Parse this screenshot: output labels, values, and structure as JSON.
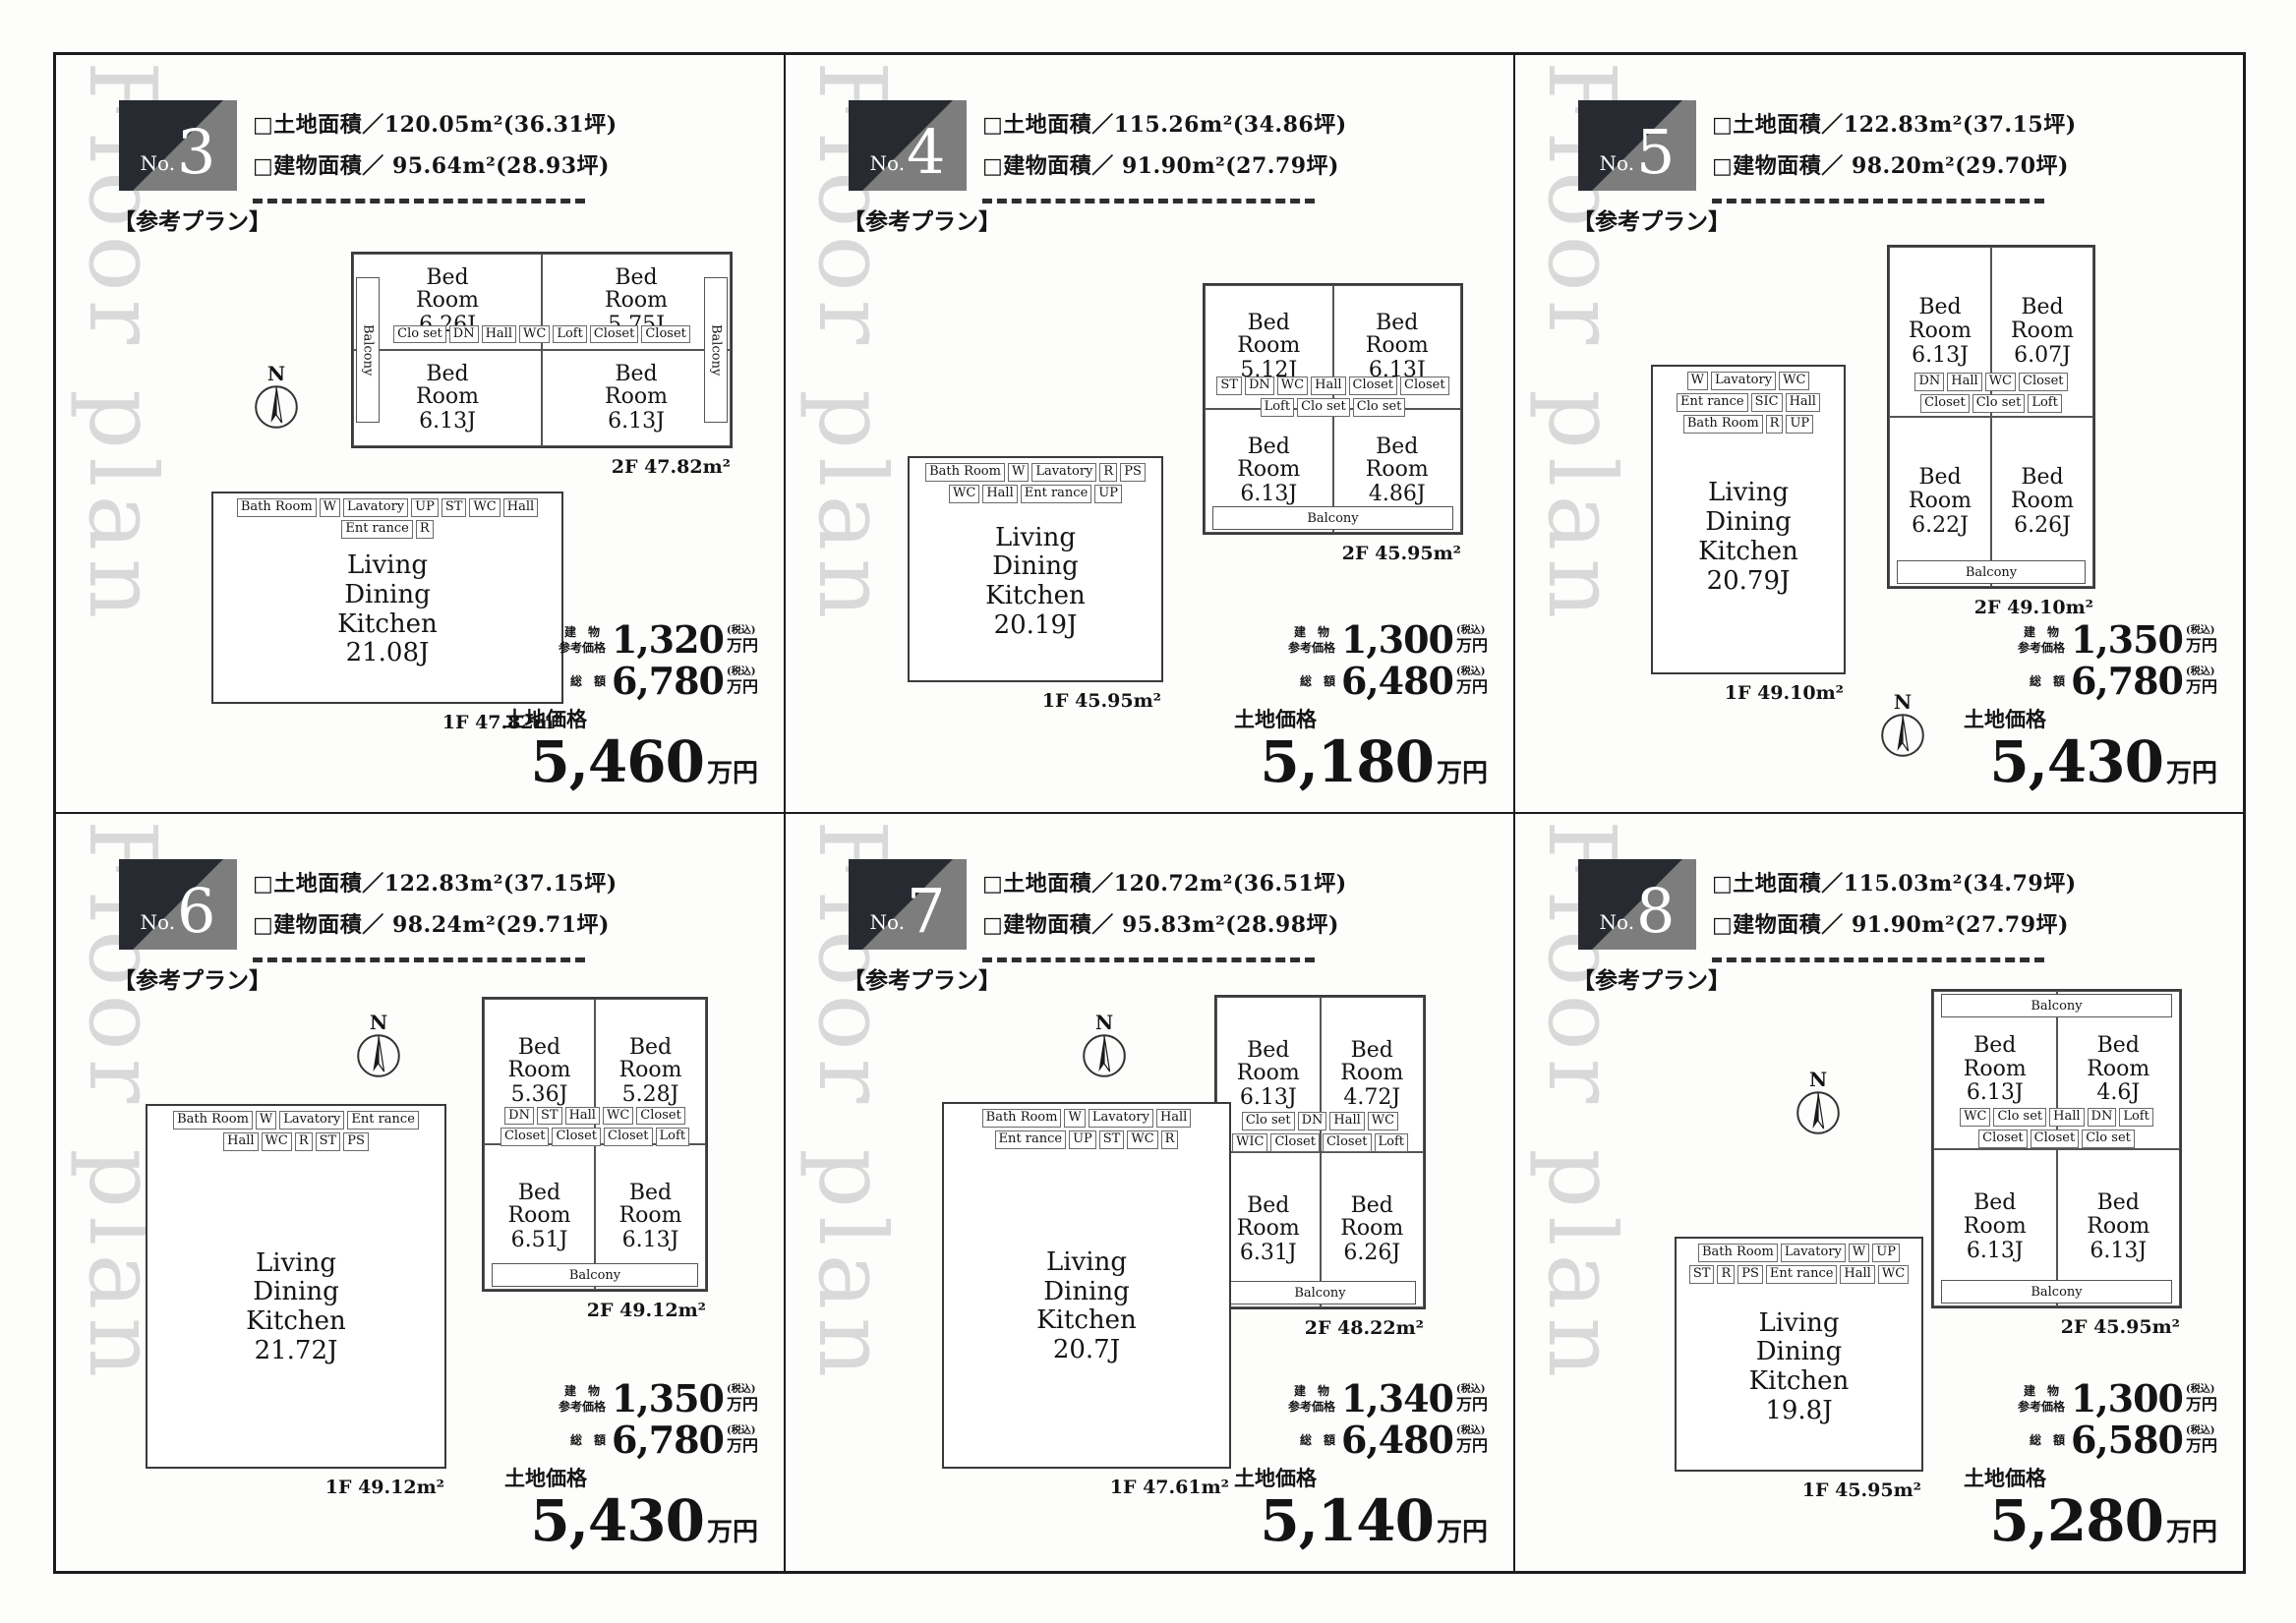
{
  "watermark": "Floor plan",
  "compass_n": "N",
  "panels": [
    {
      "badge": {
        "prefix": "No.",
        "number": "3"
      },
      "land_area": "□土地面積／120.05m²(36.31坪)",
      "building_area": "□建物面積／ 95.64m²(28.93坪)",
      "plan_note": "【参考プラン】",
      "compass": true,
      "floors": [
        {
          "id": "2F",
          "layout": "2x2",
          "area_label": "2F 47.82m²",
          "rooms": [
            {
              "name": "Bed Room",
              "size": "6.26J"
            },
            {
              "name": "Bed Room",
              "size": "5.75J"
            },
            {
              "name": "Bed Room",
              "size": "6.13J"
            },
            {
              "name": "Bed Room",
              "size": "6.13J"
            }
          ],
          "chips": [
            "Clo set",
            "DN",
            "Hall",
            "WC",
            "Loft",
            "Closet",
            "Closet"
          ],
          "balconies": [
            {
              "pos": "left",
              "label": "Balcony"
            },
            {
              "pos": "right",
              "label": "Balcony"
            }
          ]
        },
        {
          "id": "1F",
          "layout": "open",
          "area_label": "1F 47.82m²",
          "rooms": [
            {
              "name": "Living Dining Kitchen",
              "size": "21.08J"
            }
          ],
          "chips": [
            "Bath Room",
            "W",
            "Lavatory",
            "UP",
            "ST",
            "WC",
            "Hall",
            "Ent rance",
            "R"
          ],
          "balconies": []
        }
      ],
      "prices": {
        "building_label": "建　物\n参考価格",
        "building_value": "1,320",
        "tax_note": "(税込)",
        "unit": "万円",
        "total_label": "総　額",
        "total_value": "6,780",
        "land_label": "土地価格",
        "land_value": "5,460",
        "land_unit": "万円"
      }
    },
    {
      "badge": {
        "prefix": "No.",
        "number": "4"
      },
      "land_area": "□土地面積／115.26m²(34.86坪)",
      "building_area": "□建物面積／ 91.90m²(27.79坪)",
      "plan_note": "【参考プラン】",
      "compass": false,
      "floors": [
        {
          "id": "2F",
          "layout": "2x2",
          "area_label": "2F 45.95m²",
          "rooms": [
            {
              "name": "Bed Room",
              "size": "5.12J"
            },
            {
              "name": "Bed Room",
              "size": "6.13J"
            },
            {
              "name": "Bed Room",
              "size": "6.13J"
            },
            {
              "name": "Bed Room",
              "size": "4.86J"
            }
          ],
          "chips": [
            "ST",
            "DN",
            "WC",
            "Hall",
            "Closet",
            "Closet",
            "Loft",
            "Clo set",
            "Clo set"
          ],
          "balconies": [
            {
              "pos": "bottom",
              "label": "Balcony"
            }
          ]
        },
        {
          "id": "1F",
          "layout": "open",
          "area_label": "1F 45.95m²",
          "rooms": [
            {
              "name": "Living Dining Kitchen",
              "size": "20.19J"
            }
          ],
          "chips": [
            "Bath Room",
            "W",
            "Lavatory",
            "R",
            "PS",
            "WC",
            "Hall",
            "Ent rance",
            "UP"
          ],
          "balconies": []
        }
      ],
      "prices": {
        "building_label": "建　物\n参考価格",
        "building_value": "1,300",
        "tax_note": "(税込)",
        "unit": "万円",
        "total_label": "総　額",
        "total_value": "6,480",
        "land_label": "土地価格",
        "land_value": "5,180",
        "land_unit": "万円"
      }
    },
    {
      "badge": {
        "prefix": "No.",
        "number": "5"
      },
      "land_area": "□土地面積／122.83m²(37.15坪)",
      "building_area": "□建物面積／ 98.20m²(29.70坪)",
      "plan_note": "【参考プラン】",
      "compass": true,
      "floors": [
        {
          "id": "2F",
          "layout": "2x2",
          "area_label": "2F 49.10m²",
          "rooms": [
            {
              "name": "Bed Room",
              "size": "6.13J"
            },
            {
              "name": "Bed Room",
              "size": "6.07J"
            },
            {
              "name": "Bed Room",
              "size": "6.22J"
            },
            {
              "name": "Bed Room",
              "size": "6.26J"
            }
          ],
          "chips": [
            "DN",
            "Hall",
            "WC",
            "Closet",
            "Closet",
            "Clo set",
            "Loft"
          ],
          "balconies": [
            {
              "pos": "bottom",
              "label": "Balcony"
            }
          ]
        },
        {
          "id": "1F",
          "layout": "open",
          "area_label": "1F 49.10m²",
          "rooms": [
            {
              "name": "Living Dining Kitchen",
              "size": "20.79J"
            }
          ],
          "chips": [
            "W",
            "Lavatory",
            "WC",
            "Ent rance",
            "SIC",
            "Hall",
            "Bath Room",
            "R",
            "UP"
          ],
          "balconies": []
        }
      ],
      "prices": {
        "building_label": "建　物\n参考価格",
        "building_value": "1,350",
        "tax_note": "(税込)",
        "unit": "万円",
        "total_label": "総　額",
        "total_value": "6,780",
        "land_label": "土地価格",
        "land_value": "5,430",
        "land_unit": "万円"
      }
    },
    {
      "badge": {
        "prefix": "No.",
        "number": "6"
      },
      "land_area": "□土地面積／122.83m²(37.15坪)",
      "building_area": "□建物面積／ 98.24m²(29.71坪)",
      "plan_note": "【参考プラン】",
      "compass": true,
      "floors": [
        {
          "id": "2F",
          "layout": "2x2",
          "area_label": "2F 49.12m²",
          "rooms": [
            {
              "name": "Bed Room",
              "size": "5.36J"
            },
            {
              "name": "Bed Room",
              "size": "5.28J"
            },
            {
              "name": "Bed Room",
              "size": "6.51J"
            },
            {
              "name": "Bed Room",
              "size": "6.13J"
            }
          ],
          "chips": [
            "DN",
            "ST",
            "Hall",
            "WC",
            "Closet",
            "Closet",
            "Closet",
            "Closet",
            "Loft"
          ],
          "balconies": [
            {
              "pos": "bottom",
              "label": "Balcony"
            }
          ]
        },
        {
          "id": "1F",
          "layout": "open",
          "area_label": "1F 49.12m²",
          "rooms": [
            {
              "name": "Living Dining Kitchen",
              "size": "21.72J"
            }
          ],
          "chips": [
            "Bath Room",
            "W",
            "Lavatory",
            "Ent rance",
            "Hall",
            "WC",
            "R",
            "ST",
            "PS"
          ],
          "balconies": []
        }
      ],
      "prices": {
        "building_label": "建　物\n参考価格",
        "building_value": "1,350",
        "tax_note": "(税込)",
        "unit": "万円",
        "total_label": "総　額",
        "total_value": "6,780",
        "land_label": "土地価格",
        "land_value": "5,430",
        "land_unit": "万円"
      }
    },
    {
      "badge": {
        "prefix": "No.",
        "number": "7"
      },
      "land_area": "□土地面積／120.72m²(36.51坪)",
      "building_area": "□建物面積／ 95.83m²(28.98坪)",
      "plan_note": "【参考プラン】",
      "compass": true,
      "floors": [
        {
          "id": "2F",
          "layout": "2x2",
          "area_label": "2F 48.22m²",
          "rooms": [
            {
              "name": "Bed Room",
              "size": "6.13J"
            },
            {
              "name": "Bed Room",
              "size": "4.72J"
            },
            {
              "name": "Bed Room",
              "size": "6.31J"
            },
            {
              "name": "Bed Room",
              "size": "6.26J"
            }
          ],
          "chips": [
            "Clo set",
            "DN",
            "Hall",
            "WC",
            "WIC",
            "Closet",
            "Closet",
            "Loft"
          ],
          "balconies": [
            {
              "pos": "bottom",
              "label": "Balcony"
            }
          ]
        },
        {
          "id": "1F",
          "layout": "open",
          "area_label": "1F 47.61m²",
          "rooms": [
            {
              "name": "Living Dining Kitchen",
              "size": "20.7J"
            }
          ],
          "chips": [
            "Bath Room",
            "W",
            "Lavatory",
            "Hall",
            "Ent rance",
            "UP",
            "ST",
            "WC",
            "R"
          ],
          "balconies": []
        }
      ],
      "prices": {
        "building_label": "建　物\n参考価格",
        "building_value": "1,340",
        "tax_note": "(税込)",
        "unit": "万円",
        "total_label": "総　額",
        "total_value": "6,480",
        "land_label": "土地価格",
        "land_value": "5,140",
        "land_unit": "万円"
      }
    },
    {
      "badge": {
        "prefix": "No.",
        "number": "8"
      },
      "land_area": "□土地面積／115.03m²(34.79坪)",
      "building_area": "□建物面積／ 91.90m²(27.79坪)",
      "plan_note": "【参考プラン】",
      "compass": true,
      "floors": [
        {
          "id": "2F",
          "layout": "2x2",
          "area_label": "2F 45.95m²",
          "rooms": [
            {
              "name": "Bed Room",
              "size": "6.13J"
            },
            {
              "name": "Bed Room",
              "size": "4.6J"
            },
            {
              "name": "Bed Room",
              "size": "6.13J"
            },
            {
              "name": "Bed Room",
              "size": "6.13J"
            }
          ],
          "chips": [
            "WC",
            "Clo set",
            "Hall",
            "DN",
            "Loft",
            "Closet",
            "Closet",
            "Clo set"
          ],
          "balconies": [
            {
              "pos": "top",
              "label": "Balcony"
            },
            {
              "pos": "bottom",
              "label": "Balcony"
            }
          ]
        },
        {
          "id": "1F",
          "layout": "open",
          "area_label": "1F 45.95m²",
          "rooms": [
            {
              "name": "Living Dining Kitchen",
              "size": "19.8J"
            }
          ],
          "chips": [
            "Bath Room",
            "Lavatory",
            "W",
            "UP",
            "ST",
            "R",
            "PS",
            "Ent rance",
            "Hall",
            "WC"
          ],
          "balconies": []
        }
      ],
      "prices": {
        "building_label": "建　物\n参考価格",
        "building_value": "1,300",
        "tax_note": "(税込)",
        "unit": "万円",
        "total_label": "総　額",
        "total_value": "6,580",
        "land_label": "土地価格",
        "land_value": "5,280",
        "land_unit": "万円"
      }
    }
  ]
}
